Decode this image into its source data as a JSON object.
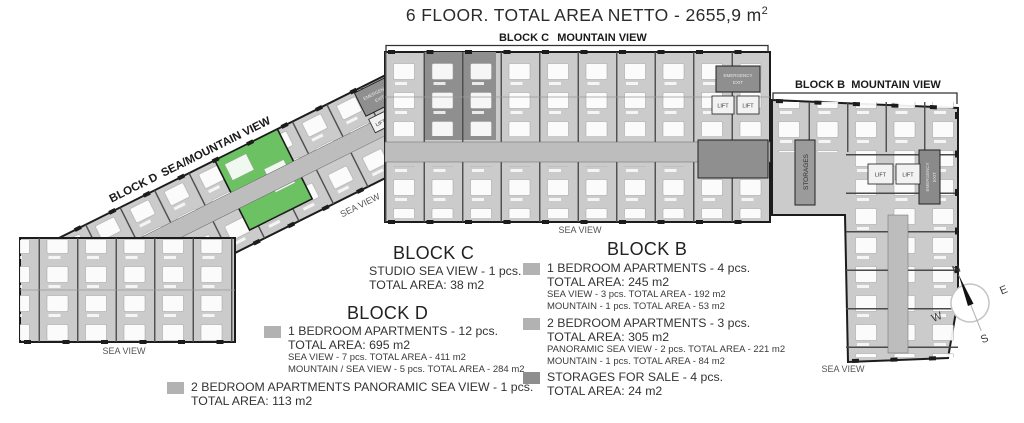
{
  "title": {
    "text": "6 FLOOR. TOTAL AREA NETTO - 2655,9 m",
    "superscript": "2"
  },
  "colors": {
    "legend_unit_gray": "#b2b2b2",
    "legend_storage_gray": "#8e8e8e",
    "highlight_green": "#6cc263"
  },
  "plan": {
    "block_c_label": "BLOCK C",
    "block_c_view": "MOUNTAIN VIEW",
    "block_b_label": "BLOCK B",
    "block_b_view": "MOUNTAIN VIEW",
    "block_d_label": "BLOCK D",
    "block_d_view": "SEA/MOUNTAIN VIEW",
    "sea_view": "SEA VIEW",
    "storages": "STORAGES",
    "lift": "LIFT",
    "emergency_exit_line1": "EMERGENCY",
    "emergency_exit_line2": "EXIT",
    "compass": {
      "n": "N",
      "e": "E",
      "s": "S",
      "w": "W"
    }
  },
  "legend": {
    "block_c": {
      "title": "BLOCK C",
      "items": [
        {
          "line1": "STUDIO SEA VIEW - 1 pcs.",
          "line2": "TOTAL AREA: 38 m2"
        }
      ]
    },
    "block_d": {
      "title": "BLOCK D",
      "items": [
        {
          "line1": "1 BEDROOM APARTMENTS - 12 pcs.",
          "line2": "TOTAL AREA: 695 m2",
          "detail1": "SEA VIEW - 7 pcs. TOTAL AREA - 411 m2",
          "detail2": "MOUNTAIN / SEA VIEW - 5 pcs. TOTAL AREA - 284 m2"
        },
        {
          "line1": "2 BEDROOM APARTMENTS PANORAMIC SEA VIEW - 1 pcs.",
          "line2": "TOTAL AREA: 113 m2"
        }
      ]
    },
    "block_b": {
      "title": "BLOCK B",
      "items": [
        {
          "line1": "1 BEDROOM APARTMENTS - 4 pcs.",
          "line2": "TOTAL AREA: 245 m2",
          "detail1": "SEA VIEW - 3 pcs. TOTAL AREA - 192 m2",
          "detail2": "MOUNTAIN - 1 pcs. TOTAL AREA - 53 m2"
        },
        {
          "line1": "2 BEDROOM APARTMENTS - 3 pcs.",
          "line2": "TOTAL AREA: 305 m2",
          "detail1": "PANORAMIC SEA VIEW - 2 pcs. TOTAL AREA - 221 m2",
          "detail2": "MOUNTAIN - 1 pcs. TOTAL AREA - 84 m2"
        },
        {
          "line1": "STORAGES FOR SALE - 4 pcs.",
          "line2": "TOTAL AREA: 24 m2"
        }
      ]
    }
  }
}
